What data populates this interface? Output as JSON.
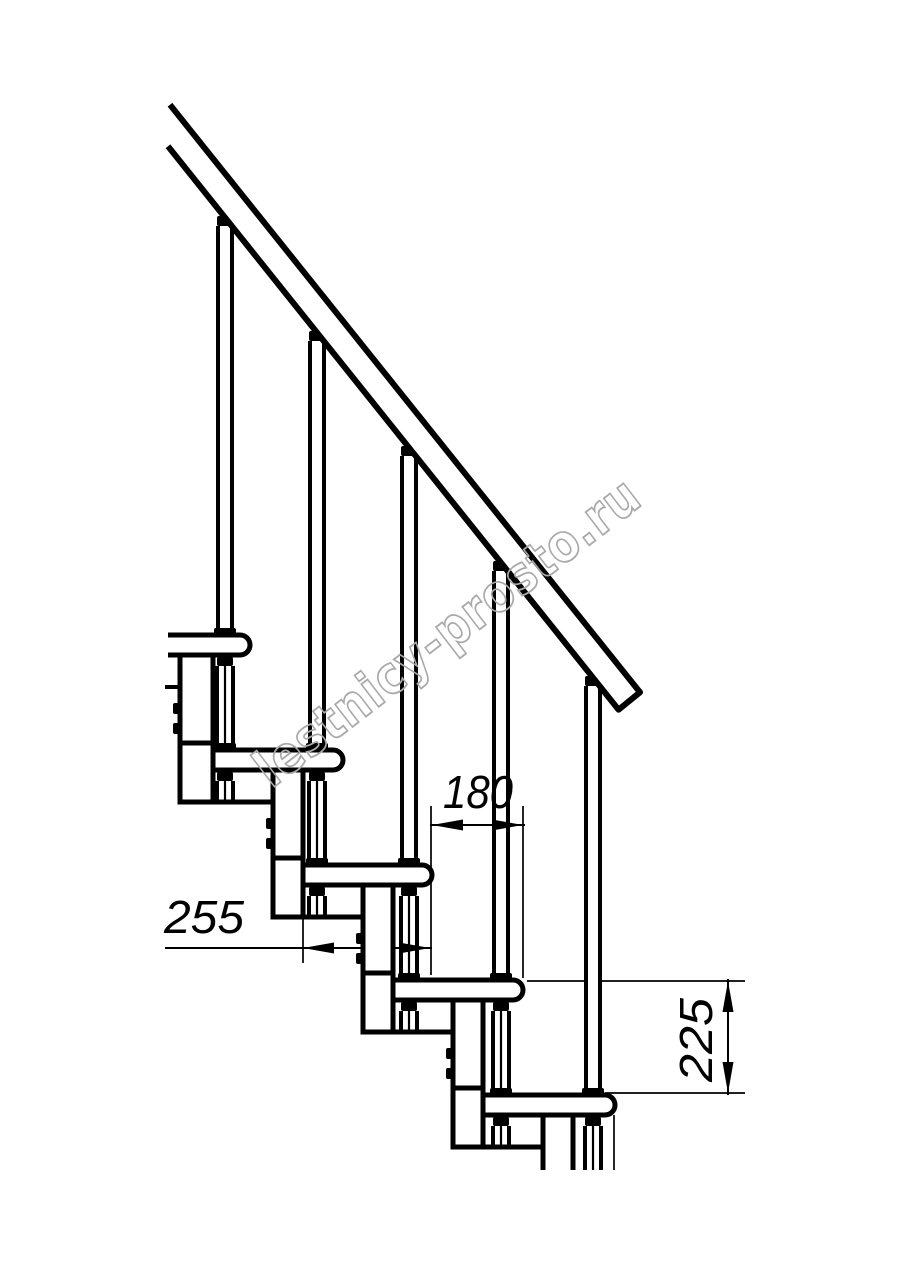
{
  "watermark": {
    "text": "lestnicy-prosto.ru",
    "color": "#a9a9a9"
  },
  "dimensions": {
    "step_run": {
      "value": "180",
      "orientation": "horizontal"
    },
    "tread_depth": {
      "value": "255",
      "orientation": "horizontal"
    },
    "step_rise": {
      "value": "225",
      "orientation": "vertical"
    }
  },
  "drawing": {
    "line_color": "#000000",
    "background": "#ffffff",
    "step_count": 5,
    "baluster_count": 5
  }
}
